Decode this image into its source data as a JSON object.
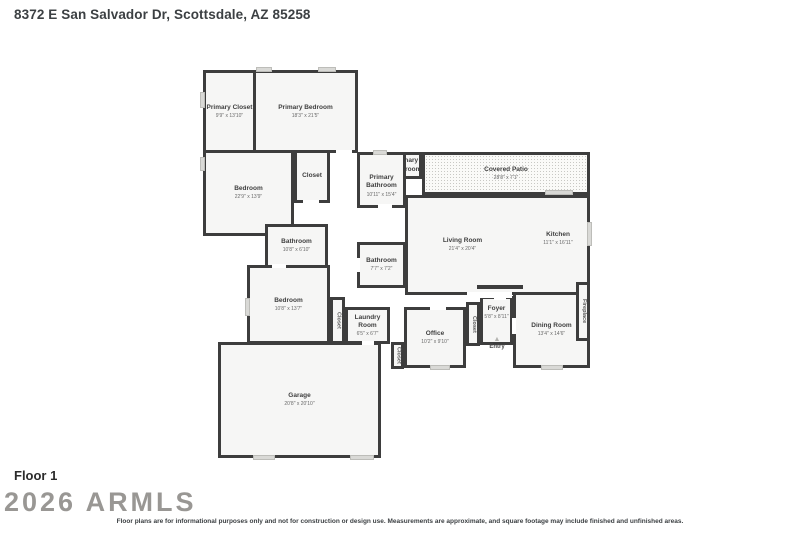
{
  "header": {
    "address": "8372 E San Salvador Dr, Scottsdale, AZ 85258"
  },
  "floor": {
    "label": "Floor 1"
  },
  "watermark": {
    "text": "2026 ARMLS"
  },
  "footer": {
    "disclaimer": "Floor plans are for informational purposes only and not for construction or design use. Measurements are approximate, and square footage may include finished and unfinished areas."
  },
  "floorplan": {
    "wall_color": "#3d3d3d",
    "floor_color": "#f6f6f5",
    "window_color": "#d9d9d6",
    "rooms": [
      {
        "id": "primary-closet",
        "name": "Primary Closet",
        "dims": "9'9\" x 13'10\"",
        "x": 203,
        "y": 70,
        "w": 53,
        "h": 83
      },
      {
        "id": "primary-bedroom",
        "name": "Primary Bedroom",
        "dims": "18'3\" x 21'5\"",
        "x": 253,
        "y": 70,
        "w": 105,
        "h": 83
      },
      {
        "id": "bedroom-1",
        "name": "Bedroom",
        "dims": "22'9\" x 13'9\"",
        "x": 203,
        "y": 150,
        "w": 91,
        "h": 86
      },
      {
        "id": "closet-1",
        "name": "Closet",
        "dims": "",
        "x": 294,
        "y": 150,
        "w": 36,
        "h": 53
      },
      {
        "id": "primary-bathroom-2",
        "name": "Primary Bathroom",
        "dims": "",
        "x": 390,
        "y": 152,
        "w": 32,
        "h": 27
      },
      {
        "id": "primary-bathroom",
        "name": "Primary Bathroom",
        "dims": "10'11\" x 15'4\"",
        "x": 357,
        "y": 152,
        "w": 49,
        "h": 56,
        "dy": 6
      },
      {
        "id": "covered-patio",
        "name": "Covered Patio",
        "dims": "28'8\" x 7'1\"",
        "x": 422,
        "y": 152,
        "w": 168,
        "h": 43,
        "patio": true
      },
      {
        "id": "living-room",
        "name": "Living Room",
        "dims": "21'4\" x 20'4\"",
        "x": 405,
        "y": 195,
        "w": 185,
        "h": 100,
        "dx": -35
      },
      {
        "id": "kitchen",
        "name": "Kitchen",
        "dims": "11'1\" x 16'11\"",
        "x": 527,
        "y": 228,
        "w": 62,
        "h": 22,
        "border": false
      },
      {
        "id": "bathroom-1",
        "name": "Bathroom",
        "dims": "10'8\" x 6'10\"",
        "x": 265,
        "y": 224,
        "w": 63,
        "h": 44
      },
      {
        "id": "bathroom-2",
        "name": "Bathroom",
        "dims": "7'7\" x 7'2\"",
        "x": 357,
        "y": 242,
        "w": 49,
        "h": 46
      },
      {
        "id": "bedroom-2",
        "name": "Bedroom",
        "dims": "10'8\" x 13'7\"",
        "x": 247,
        "y": 265,
        "w": 83,
        "h": 79
      },
      {
        "id": "closet-2",
        "name": "Closet",
        "dims": "",
        "x": 330,
        "y": 297,
        "w": 15,
        "h": 47,
        "vertical": true
      },
      {
        "id": "laundry-room",
        "name": "Laundry Room",
        "dims": "6'5\" x 6'7\"",
        "x": 345,
        "y": 307,
        "w": 45,
        "h": 37
      },
      {
        "id": "closet-3",
        "name": "Closet",
        "dims": "",
        "x": 391,
        "y": 342,
        "w": 13,
        "h": 27,
        "vertical": true
      },
      {
        "id": "office",
        "name": "Office",
        "dims": "10'2\" x 9'10\"",
        "x": 404,
        "y": 307,
        "w": 62,
        "h": 61
      },
      {
        "id": "closet-4",
        "name": "Closet",
        "dims": "",
        "x": 466,
        "y": 302,
        "w": 14,
        "h": 44,
        "vertical": true
      },
      {
        "id": "foyer",
        "name": "Foyer",
        "dims": "5'8\" x 8'11\"",
        "x": 480,
        "y": 296,
        "w": 33,
        "h": 49,
        "dy": -8
      },
      {
        "id": "dining-room",
        "name": "Dining Room",
        "dims": "13'4\" x 14'6\"",
        "x": 513,
        "y": 292,
        "w": 77,
        "h": 76
      },
      {
        "id": "fireplace",
        "name": "Fireplace",
        "dims": "",
        "x": 576,
        "y": 282,
        "w": 14,
        "h": 59,
        "vertical": true
      },
      {
        "id": "garage",
        "name": "Garage",
        "dims": "20'8\" x 20'10\"",
        "x": 218,
        "y": 342,
        "w": 163,
        "h": 116
      }
    ],
    "extra_walls": [
      {
        "x": 477,
        "y": 285,
        "w": 46,
        "h": 4
      }
    ],
    "openings": [
      {
        "x": 303,
        "y": 200,
        "w": 16,
        "h": 4
      },
      {
        "x": 272,
        "y": 264,
        "w": 14,
        "h": 4
      },
      {
        "x": 336,
        "y": 150,
        "w": 16,
        "h": 4
      },
      {
        "x": 378,
        "y": 204,
        "w": 14,
        "h": 4
      },
      {
        "x": 356,
        "y": 258,
        "w": 4,
        "h": 14
      },
      {
        "x": 430,
        "y": 306,
        "w": 16,
        "h": 4
      },
      {
        "x": 494,
        "y": 296,
        "w": 12,
        "h": 4
      },
      {
        "x": 512,
        "y": 318,
        "w": 4,
        "h": 16
      },
      {
        "x": 362,
        "y": 341,
        "w": 12,
        "h": 4
      },
      {
        "x": 467,
        "y": 292,
        "w": 45,
        "h": 6
      }
    ],
    "windows": [
      {
        "x": 256,
        "y": 67,
        "w": 16,
        "h": 5
      },
      {
        "x": 318,
        "y": 67,
        "w": 18,
        "h": 5
      },
      {
        "x": 200,
        "y": 92,
        "w": 5,
        "h": 16
      },
      {
        "x": 200,
        "y": 157,
        "w": 5,
        "h": 14
      },
      {
        "x": 245,
        "y": 298,
        "w": 5,
        "h": 18
      },
      {
        "x": 373,
        "y": 150,
        "w": 14,
        "h": 5
      },
      {
        "x": 545,
        "y": 190,
        "w": 28,
        "h": 5
      },
      {
        "x": 587,
        "y": 222,
        "w": 5,
        "h": 24
      },
      {
        "x": 253,
        "y": 455,
        "w": 22,
        "h": 5
      },
      {
        "x": 350,
        "y": 455,
        "w": 24,
        "h": 5
      },
      {
        "x": 430,
        "y": 365,
        "w": 20,
        "h": 5
      },
      {
        "x": 541,
        "y": 365,
        "w": 22,
        "h": 5
      }
    ],
    "entry": {
      "label": "Entry",
      "icon": "triangle",
      "x": 486,
      "y": 336
    }
  }
}
